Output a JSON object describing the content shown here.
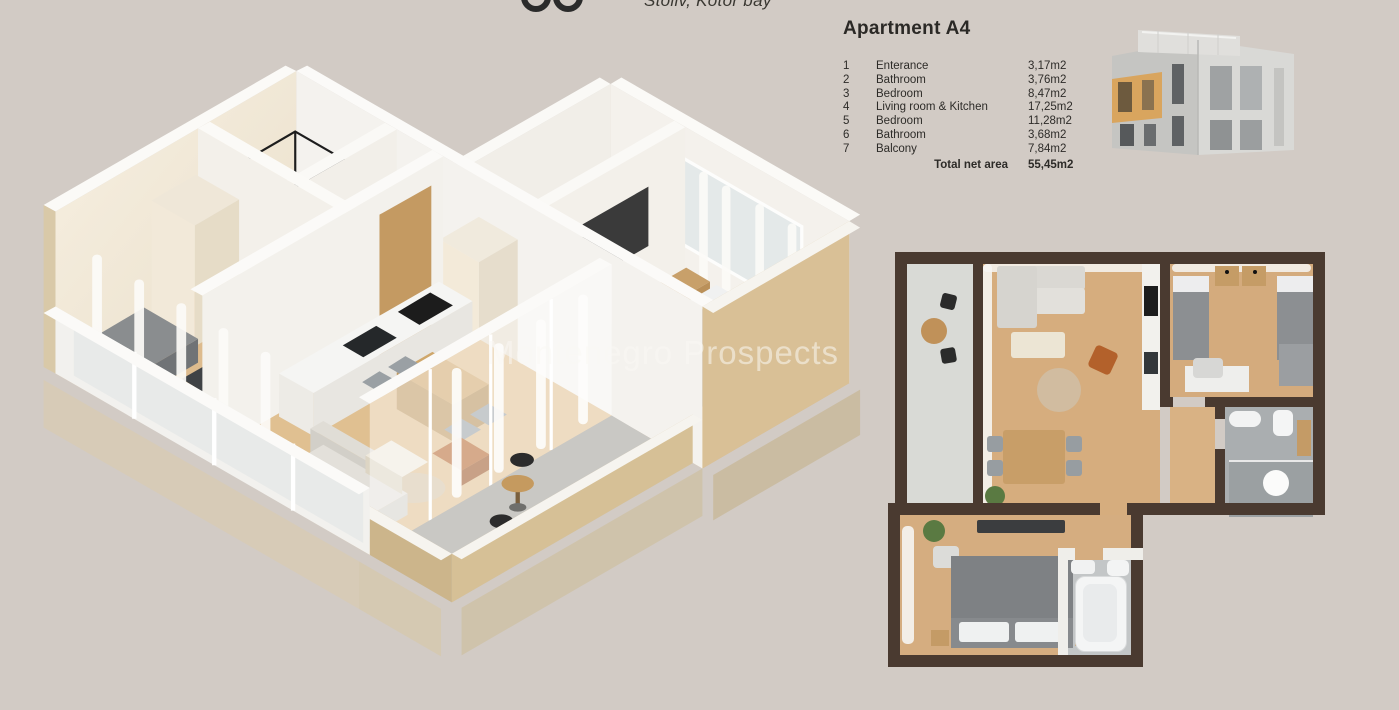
{
  "header": {
    "tagline": "Stoliv, Kotor bay",
    "logo": "partial-brand-logo"
  },
  "apartment": {
    "title": "Apartment A4",
    "rooms": [
      {
        "num": "1",
        "name": "Enterance",
        "area": "3,17m2"
      },
      {
        "num": "2",
        "name": "Bathroom",
        "area": "3,76m2"
      },
      {
        "num": "3",
        "name": "Bedroom",
        "area": "8,47m2"
      },
      {
        "num": "4",
        "name": "Living room & Kitchen",
        "area": "17,25m2"
      },
      {
        "num": "5",
        "name": "Bedroom",
        "area": "11,28m2"
      },
      {
        "num": "6",
        "name": "Bathroom",
        "area": "3,68m2"
      },
      {
        "num": "7",
        "name": "Balcony",
        "area": "7,84m2"
      }
    ],
    "total_label": "Total net area",
    "total_area": "55,45m2"
  },
  "watermark": "Montenegro Prospects",
  "colors": {
    "background": "#d2cbc5",
    "plan_wall_dark": "#4a3a30",
    "wood_floor": "#d2a97a",
    "balcony_floor": "#c9c8c4",
    "wall_white": "#f4f2ee",
    "exterior_beige": "#d9c096",
    "highlight_unit_orange": "#d9a55e",
    "bed_gray": "#85888b",
    "accent_chair_orange": "#b3612b",
    "text_dark": "#2d2b28"
  },
  "figures": {
    "plan3d_label": "3D isometric floor plan",
    "plan2d_label": "2D top-down floor plan",
    "building_label": "Building exterior with highlighted apartment"
  }
}
